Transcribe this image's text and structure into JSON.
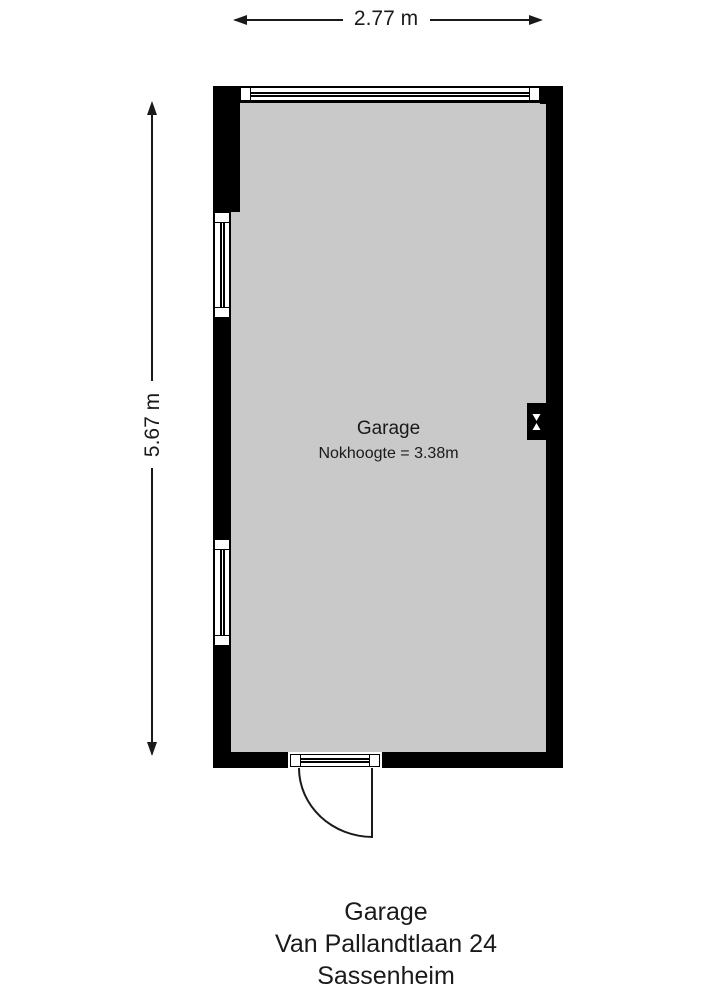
{
  "dimensions": {
    "width": "2.77 m",
    "height": "5.67 m"
  },
  "room": {
    "name": "Garage",
    "ridge_height": "Nokhoogte = 3.38m"
  },
  "caption": {
    "lines": [
      "Garage",
      "Van Pallandtlaan 24",
      "Sassenheim"
    ]
  },
  "icons": {
    "ventilation": "hourglass-vent-symbol"
  },
  "colors": {
    "wall": "#000000",
    "floor": "#c9c9c9",
    "canvas": "#ffffff",
    "line": "#1a1a1a"
  }
}
